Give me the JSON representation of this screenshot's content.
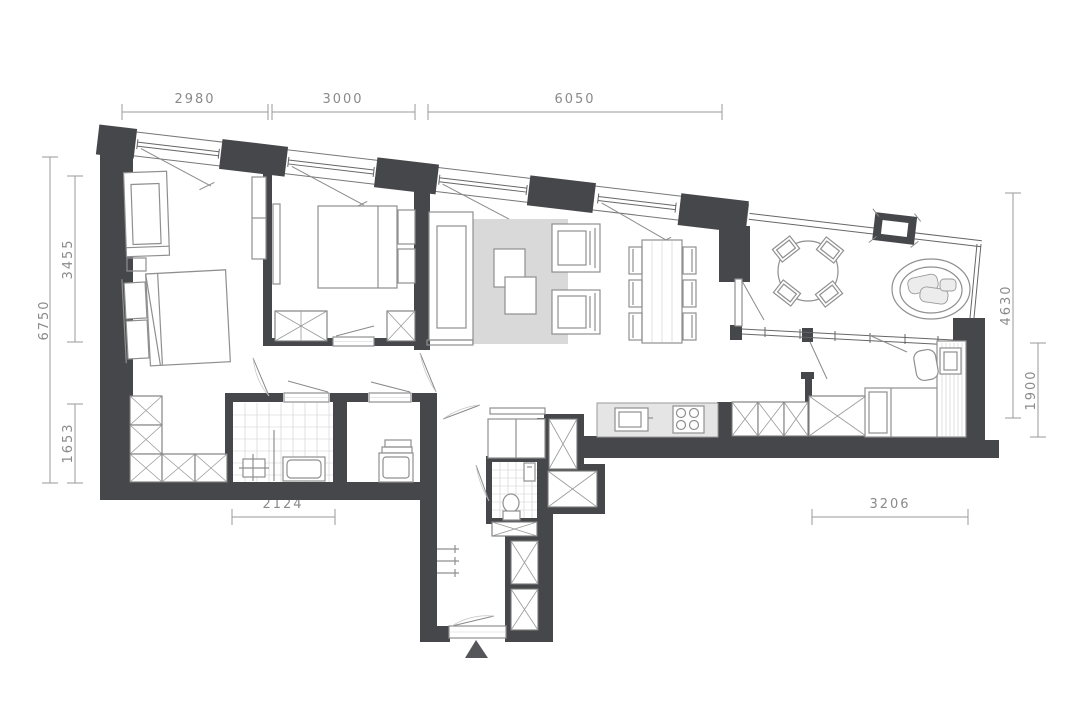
{
  "colors": {
    "wall": "#46474a",
    "line": "#8f8f8f",
    "rug": "#d9d9d9",
    "counter": "#e5e5e5",
    "cushion": "#ececec",
    "dim": "#9a9a9a"
  },
  "floorplan": {
    "dimensions": {
      "top_1": "2980",
      "top_2": "3000",
      "top_3": "6050",
      "left_total": "6750",
      "left_upper": "3455",
      "left_lower": "1653",
      "bottom_left": "2124",
      "bottom_right": "3206",
      "right_total": "4630",
      "right_lower": "1900"
    }
  }
}
